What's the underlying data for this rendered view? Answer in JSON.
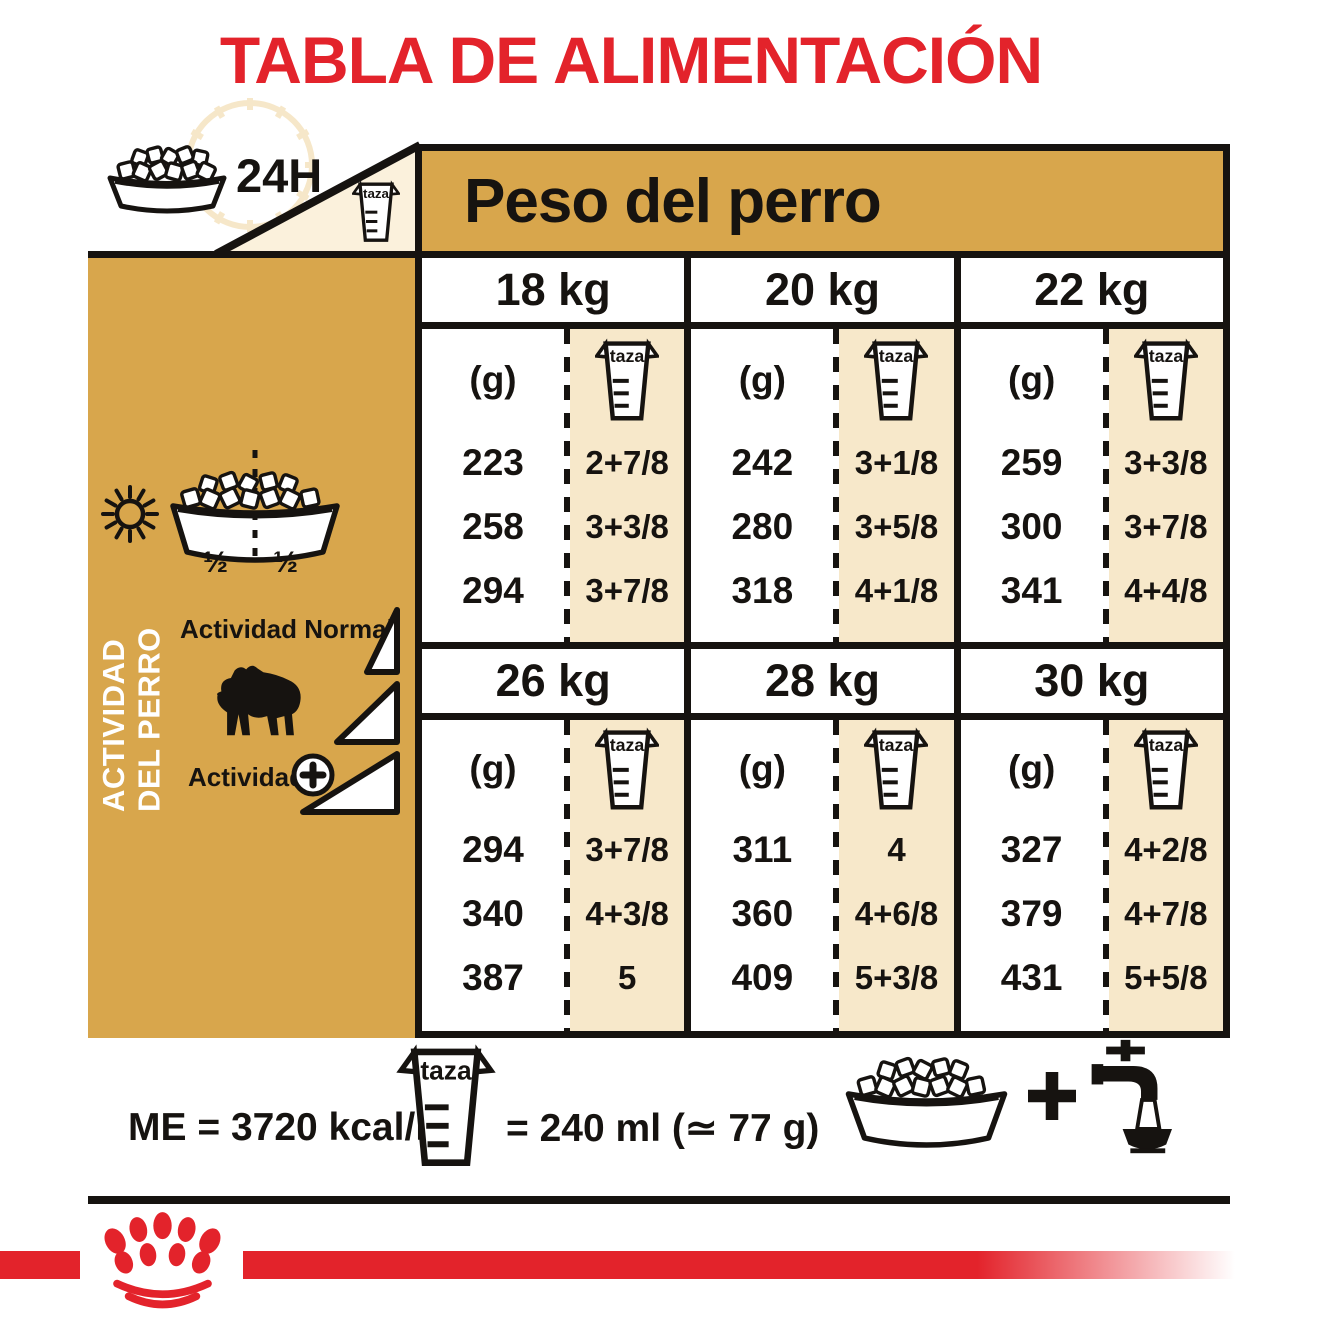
{
  "title": "TABLA DE ALIMENTACIÓN",
  "topleft": {
    "hours": "24H"
  },
  "labels": {
    "taza": "taza"
  },
  "band": {
    "title": "Peso del perro"
  },
  "sidebar": {
    "vertical_line1": "ACTIVIDAD",
    "vertical_line2": "DEL PERRO",
    "half_left": "½",
    "half_right": "½",
    "normal_activity": "Actividad Normal",
    "plus_activity": "Actividad"
  },
  "table": {
    "grams_header": "(g)",
    "groups": [
      {
        "columns": [
          {
            "weight": "18 kg",
            "grams": [
              "223",
              "258",
              "294"
            ],
            "cups": [
              "2+7/8",
              "3+3/8",
              "3+7/8"
            ]
          },
          {
            "weight": "20 kg",
            "grams": [
              "242",
              "280",
              "318"
            ],
            "cups": [
              "3+1/8",
              "3+5/8",
              "4+1/8"
            ]
          },
          {
            "weight": "22 kg",
            "grams": [
              "259",
              "300",
              "341"
            ],
            "cups": [
              "3+3/8",
              "3+7/8",
              "4+4/8"
            ]
          }
        ]
      },
      {
        "columns": [
          {
            "weight": "26 kg",
            "grams": [
              "294",
              "340",
              "387"
            ],
            "cups": [
              "3+7/8",
              "4+3/8",
              "5"
            ]
          },
          {
            "weight": "28 kg",
            "grams": [
              "311",
              "360",
              "409"
            ],
            "cups": [
              "4",
              "4+6/8",
              "5+3/8"
            ]
          },
          {
            "weight": "30 kg",
            "grams": [
              "327",
              "379",
              "431"
            ],
            "cups": [
              "4+2/8",
              "4+7/8",
              "5+5/8"
            ]
          }
        ]
      }
    ]
  },
  "footer": {
    "me": "ME = 3720 kcal/kg",
    "cup_equals": "= 240 ml (≃ 77 g)"
  },
  "icons": [
    "kibble-bowl-icon",
    "clock-icon",
    "measuring-cup-icon",
    "sun-icon",
    "moon-icon",
    "bulldog-icon",
    "activity-wedge-icon",
    "plus-circle-icon",
    "plus-icon",
    "water-tap-icon",
    "royal-canin-crown-logo"
  ],
  "colors": {
    "accent_red": "#E3232B",
    "gold": "#D8A64C",
    "cream": "#FBF1DC",
    "tan": "#F7E8CA",
    "ink": "#161310"
  }
}
